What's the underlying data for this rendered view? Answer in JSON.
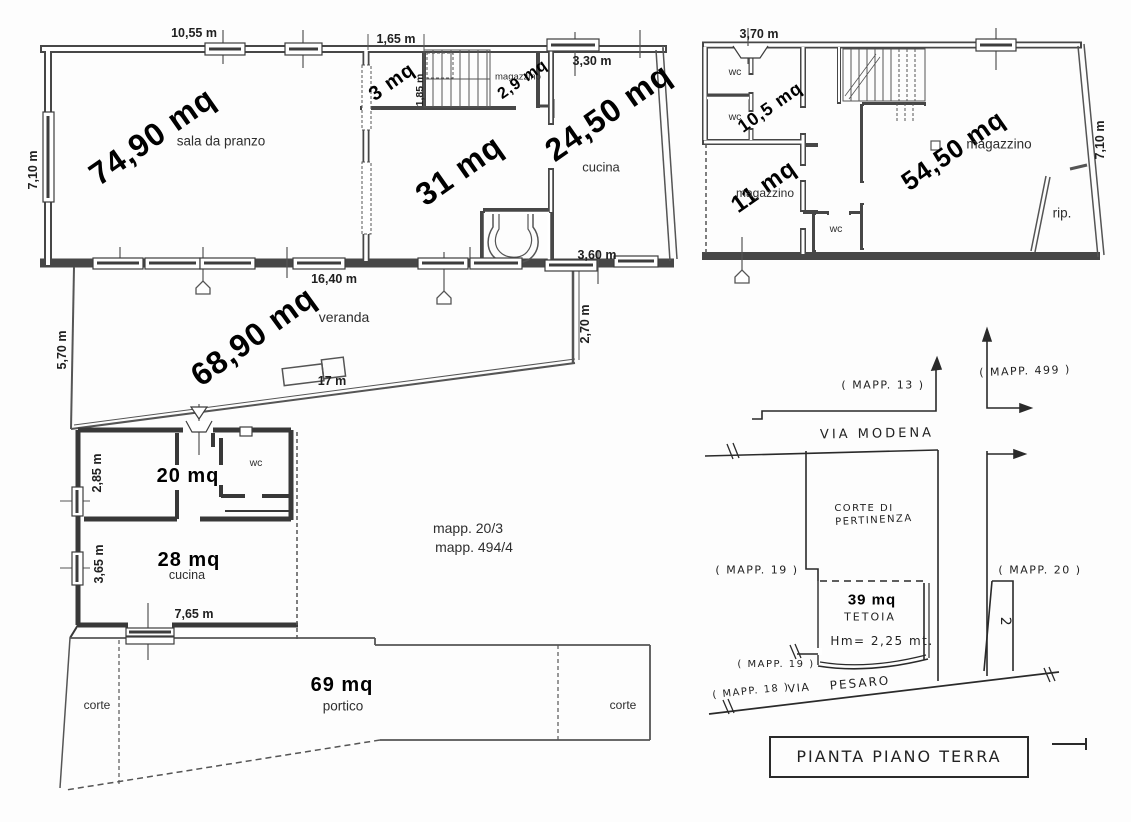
{
  "colors": {
    "ink": "#474747",
    "thin_line": "#555555",
    "hand_ink": "#2a2a2a",
    "paper": "#ffffff",
    "text": "#141414"
  },
  "plan1": {
    "dim_top_width": "10,55 m",
    "dim_top_opening": "1,65 m",
    "dim_kitchen_window": "3,30 m",
    "dim_left_height": "7,10 m",
    "dim_stairs_width": "1,85 m",
    "area_dining": "74,90 mq",
    "room_dining": "sala da pranzo",
    "area_closet": "3 mq",
    "room_small_storage": "magazzino",
    "area_small_storage": "2,9 mq",
    "area_central_room": "31 mq",
    "area_kitchen": "24,50 mq",
    "room_kitchen": "cucina",
    "dim_bottom_window": "3,60 m",
    "dim_veranda_top": "16,40 m",
    "area_veranda": "68,90 mq",
    "room_veranda": "veranda",
    "dim_veranda_left": "5,70 m",
    "dim_veranda_right": "2,70 m",
    "dim_veranda_bottom": "17 m"
  },
  "plan2": {
    "dim_top_window": "3,70 m",
    "room_wc1": "wc",
    "room_wc2": "wc",
    "area_hall": "10,5 mq",
    "area_main_storage": "54,50 mq",
    "room_main_storage": "magazzino",
    "dim_right_height": "7,10 m",
    "area_storage": "11 mq",
    "room_storage": "magazzino",
    "room_wc3": "wc",
    "room_closet": "rip."
  },
  "plan3": {
    "dim_room1_height": "2,85 m",
    "area_room1": "20 mq",
    "room_wc": "wc",
    "dim_kitchen_height": "3,65 m",
    "area_kitchen": "28 mq",
    "room_kitchen": "cucina",
    "dim_kitchen_width": "7,65 m",
    "parcel_note1": "mapp. 20/3",
    "parcel_note2": "mapp. 494/4",
    "area_porch": "69 mq",
    "room_porch": "portico",
    "court_left": "corte",
    "court_right": "corte"
  },
  "siteplan": {
    "mapp_13": "( MAPP. 13 )",
    "mapp_499": "( MAPP. 499 )",
    "street_top": "VIA MODENA",
    "court_line1": "CORTE DI",
    "court_line2": "PERTINENZA",
    "mapp_19_left": "( MAPP. 19 )",
    "mapp_20": "( MAPP. 20 )",
    "area_canopy": "39 mq",
    "room_canopy": "TETOIA",
    "canopy_height": "Hm= 2,25 mt.",
    "mapp_19_bottom": "( MAPP. 19 )",
    "mapp_18": "( MAPP. 18 )",
    "street_bottom_via": "VIA",
    "street_bottom_name": "PESARO",
    "parcel_2": "2",
    "title": "PIANTA PIANO TERRA"
  }
}
